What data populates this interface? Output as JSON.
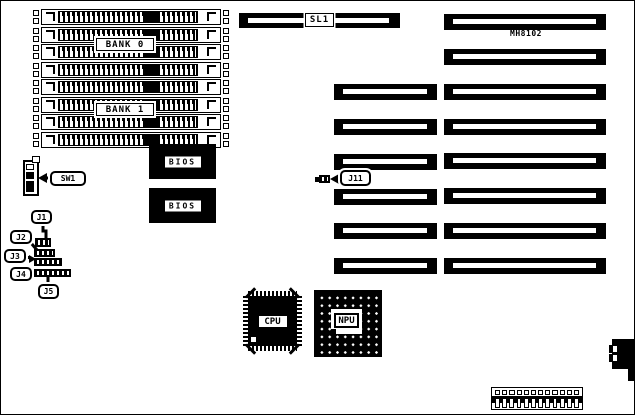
{
  "colors": {
    "ink": "#000000",
    "paper": "#ffffff"
  },
  "memory": {
    "bank0_label": "BANK 0",
    "bank1_label": "BANK 1",
    "simm_socket_count": 8
  },
  "expansion": {
    "sl1_label": "SL1",
    "board_model": "MH8102",
    "short_slot_count": 6,
    "long_slot_count": 8
  },
  "chips": {
    "bios_top_label": "BIOS",
    "bios_bottom_label": "BIOS",
    "cpu_label": "CPU",
    "npu_label": "NPU"
  },
  "switches": {
    "sw1_label": "SW1"
  },
  "jumpers": {
    "j1_label": "J1",
    "j2_label": "J2",
    "j3_label": "J3",
    "j4_label": "J4",
    "j5_label": "J5",
    "j11_label": "J11"
  },
  "power_connector": {
    "pin_count": 12
  }
}
